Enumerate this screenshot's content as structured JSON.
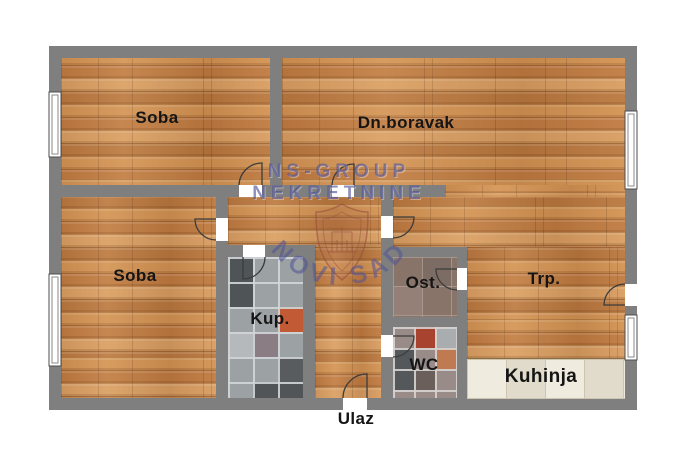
{
  "plan": {
    "rooms": {
      "soba_top": "Soba",
      "dn_boravak": "Dn.boravak",
      "soba_bottom": "Soba",
      "kup": "Kup.",
      "ost": "Ost.",
      "wc": "WC",
      "trp": "Trp.",
      "kuhinja": "Kuhinja"
    },
    "entrance_label": "Ulaz",
    "watermark": {
      "line1": "NS-GROUP",
      "line2": "NEKRETNINE",
      "arc": "NOVI SAD"
    },
    "colors": {
      "background": "#ffffff",
      "wall": "#7f7f7f",
      "wood_base": "#c98a50",
      "kup_tile_base": "#9ca1a3",
      "wc_tile_base": "#988b88",
      "ost_tile_base": "#887469",
      "kitchen_tile_base": "#eae4d3",
      "tile_accent_red": "#c25a36",
      "watermark_blue": "#4a4e94",
      "watermark_shield": "#96463a",
      "label_text": "#151515"
    }
  }
}
